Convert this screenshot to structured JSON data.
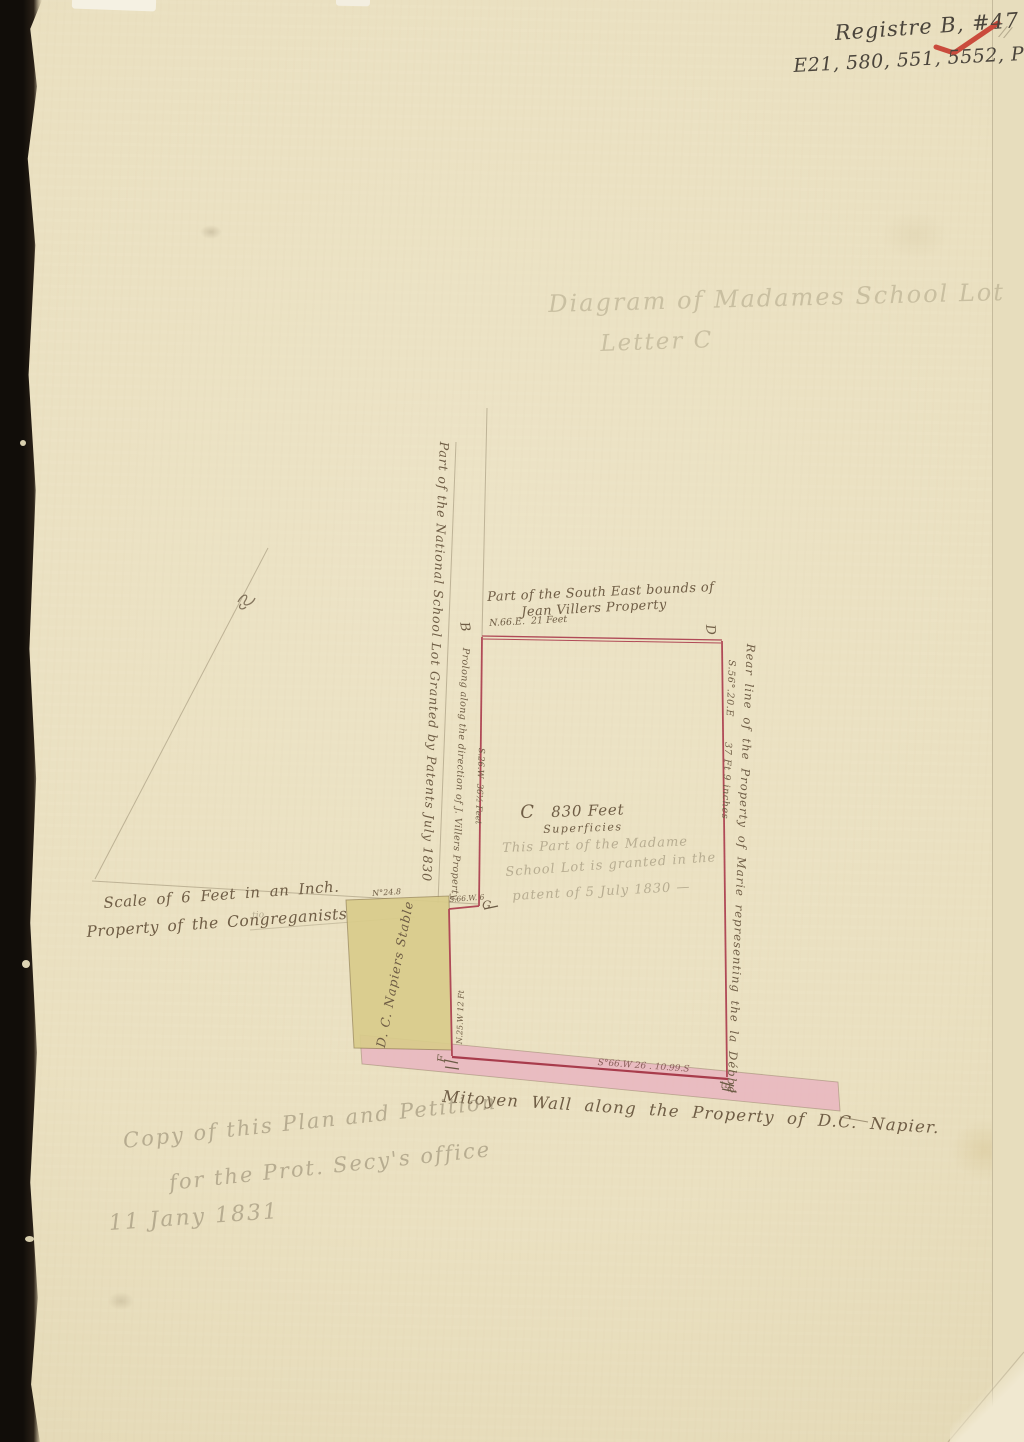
{
  "registry": {
    "line1": "Registre B, #47",
    "line2": "E21, 580, 551, 5552, PB047",
    "corner_marks": "//"
  },
  "pencil_title": {
    "line1": "Diagram of Madames School Lot",
    "line2": "Letter C"
  },
  "diagram": {
    "corner_labels": {
      "b": "B",
      "d": "D",
      "e": "E",
      "f": "F",
      "g": "G"
    },
    "top_note_line1": "Part of the South East bounds of",
    "top_note_line2": "Jean Villers Property",
    "top_bearing": "N.66.E.  21 Feet",
    "right_note": "Rear line of the Property of Marie representing the la Débbé",
    "right_bearing": "S.56°.20.E       37 Ft 9 inches",
    "center_letter": "C",
    "center_area": "830 Feet",
    "center_area_unit": "Superficies",
    "center_pencil_line1": "This Part of the Madame",
    "center_pencil_line2": "School Lot is granted in the",
    "center_pencil_line3": "patent of 5 July 1830 —",
    "left_outer_note": "Part of the National School Lot Granted by Patents July 1830",
    "left_inner_note": "Prolong along the direction of J. Villers Property",
    "left_bearing": "S.26.W  36½ Feet",
    "jog_bearing": "S.66.W. 6",
    "stable_label": "D. C. Napiers Stable",
    "stable_top_dim": "N°24.8",
    "stable_side_dim": "N.25.W 12 Ft",
    "wall_bearing": "S°66.W 26 . 10.99.S",
    "wall_caption": "Mitoyen Wall along the Property of D.C. Napier.",
    "scale_note": "Scale of 6 Feet in an Inch.",
    "owner_note": "Property of the Congreganists",
    "owner_insert": "tio"
  },
  "footer_pencil": {
    "line1": "Copy of this Plan and Petition",
    "line2": "for the Prot. Secy's office",
    "line3": "11 Jany 1831"
  }
}
